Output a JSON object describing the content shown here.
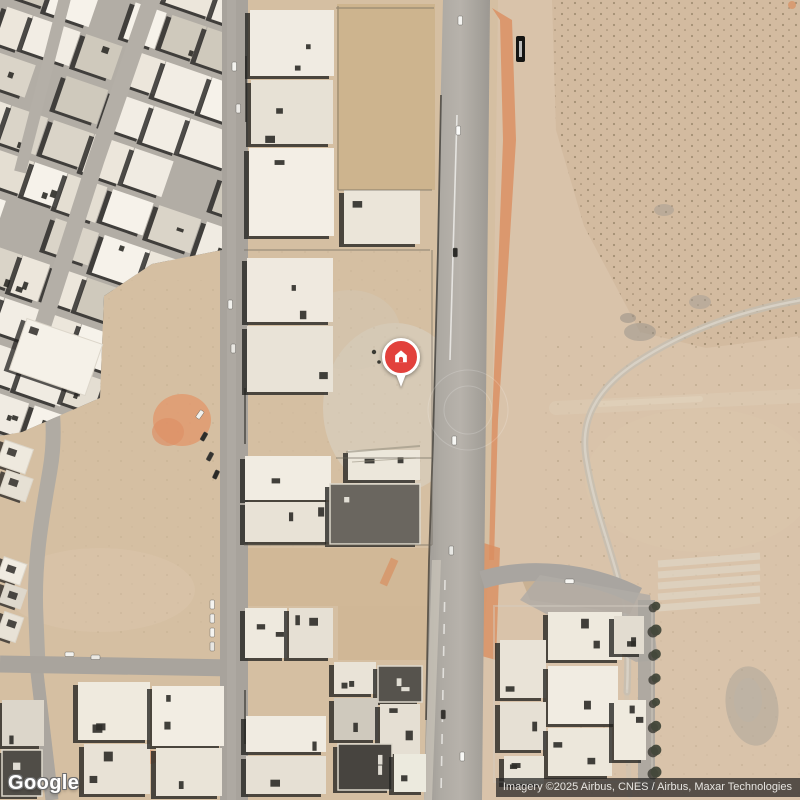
{
  "map": {
    "view_type": "satellite",
    "logo_text": "Google",
    "attribution_text": "Imagery ©2025 Airbus, CNES / Airbus, Maxar Technologies",
    "marker": {
      "label": "property-location",
      "icon": "home-icon",
      "x": 401,
      "y": 357
    },
    "colors": {
      "marker_red": "#E2413C",
      "marker_ring": "#FFFFFF",
      "desert": "#D5BFA2",
      "desert_right": "#D9C3AA",
      "road": "#A9A49D",
      "building_light": "#F1ECE3",
      "building_shadow": "#2B2927",
      "dirt_orange": "#DB9164",
      "trail": "#C3BDB2"
    }
  }
}
